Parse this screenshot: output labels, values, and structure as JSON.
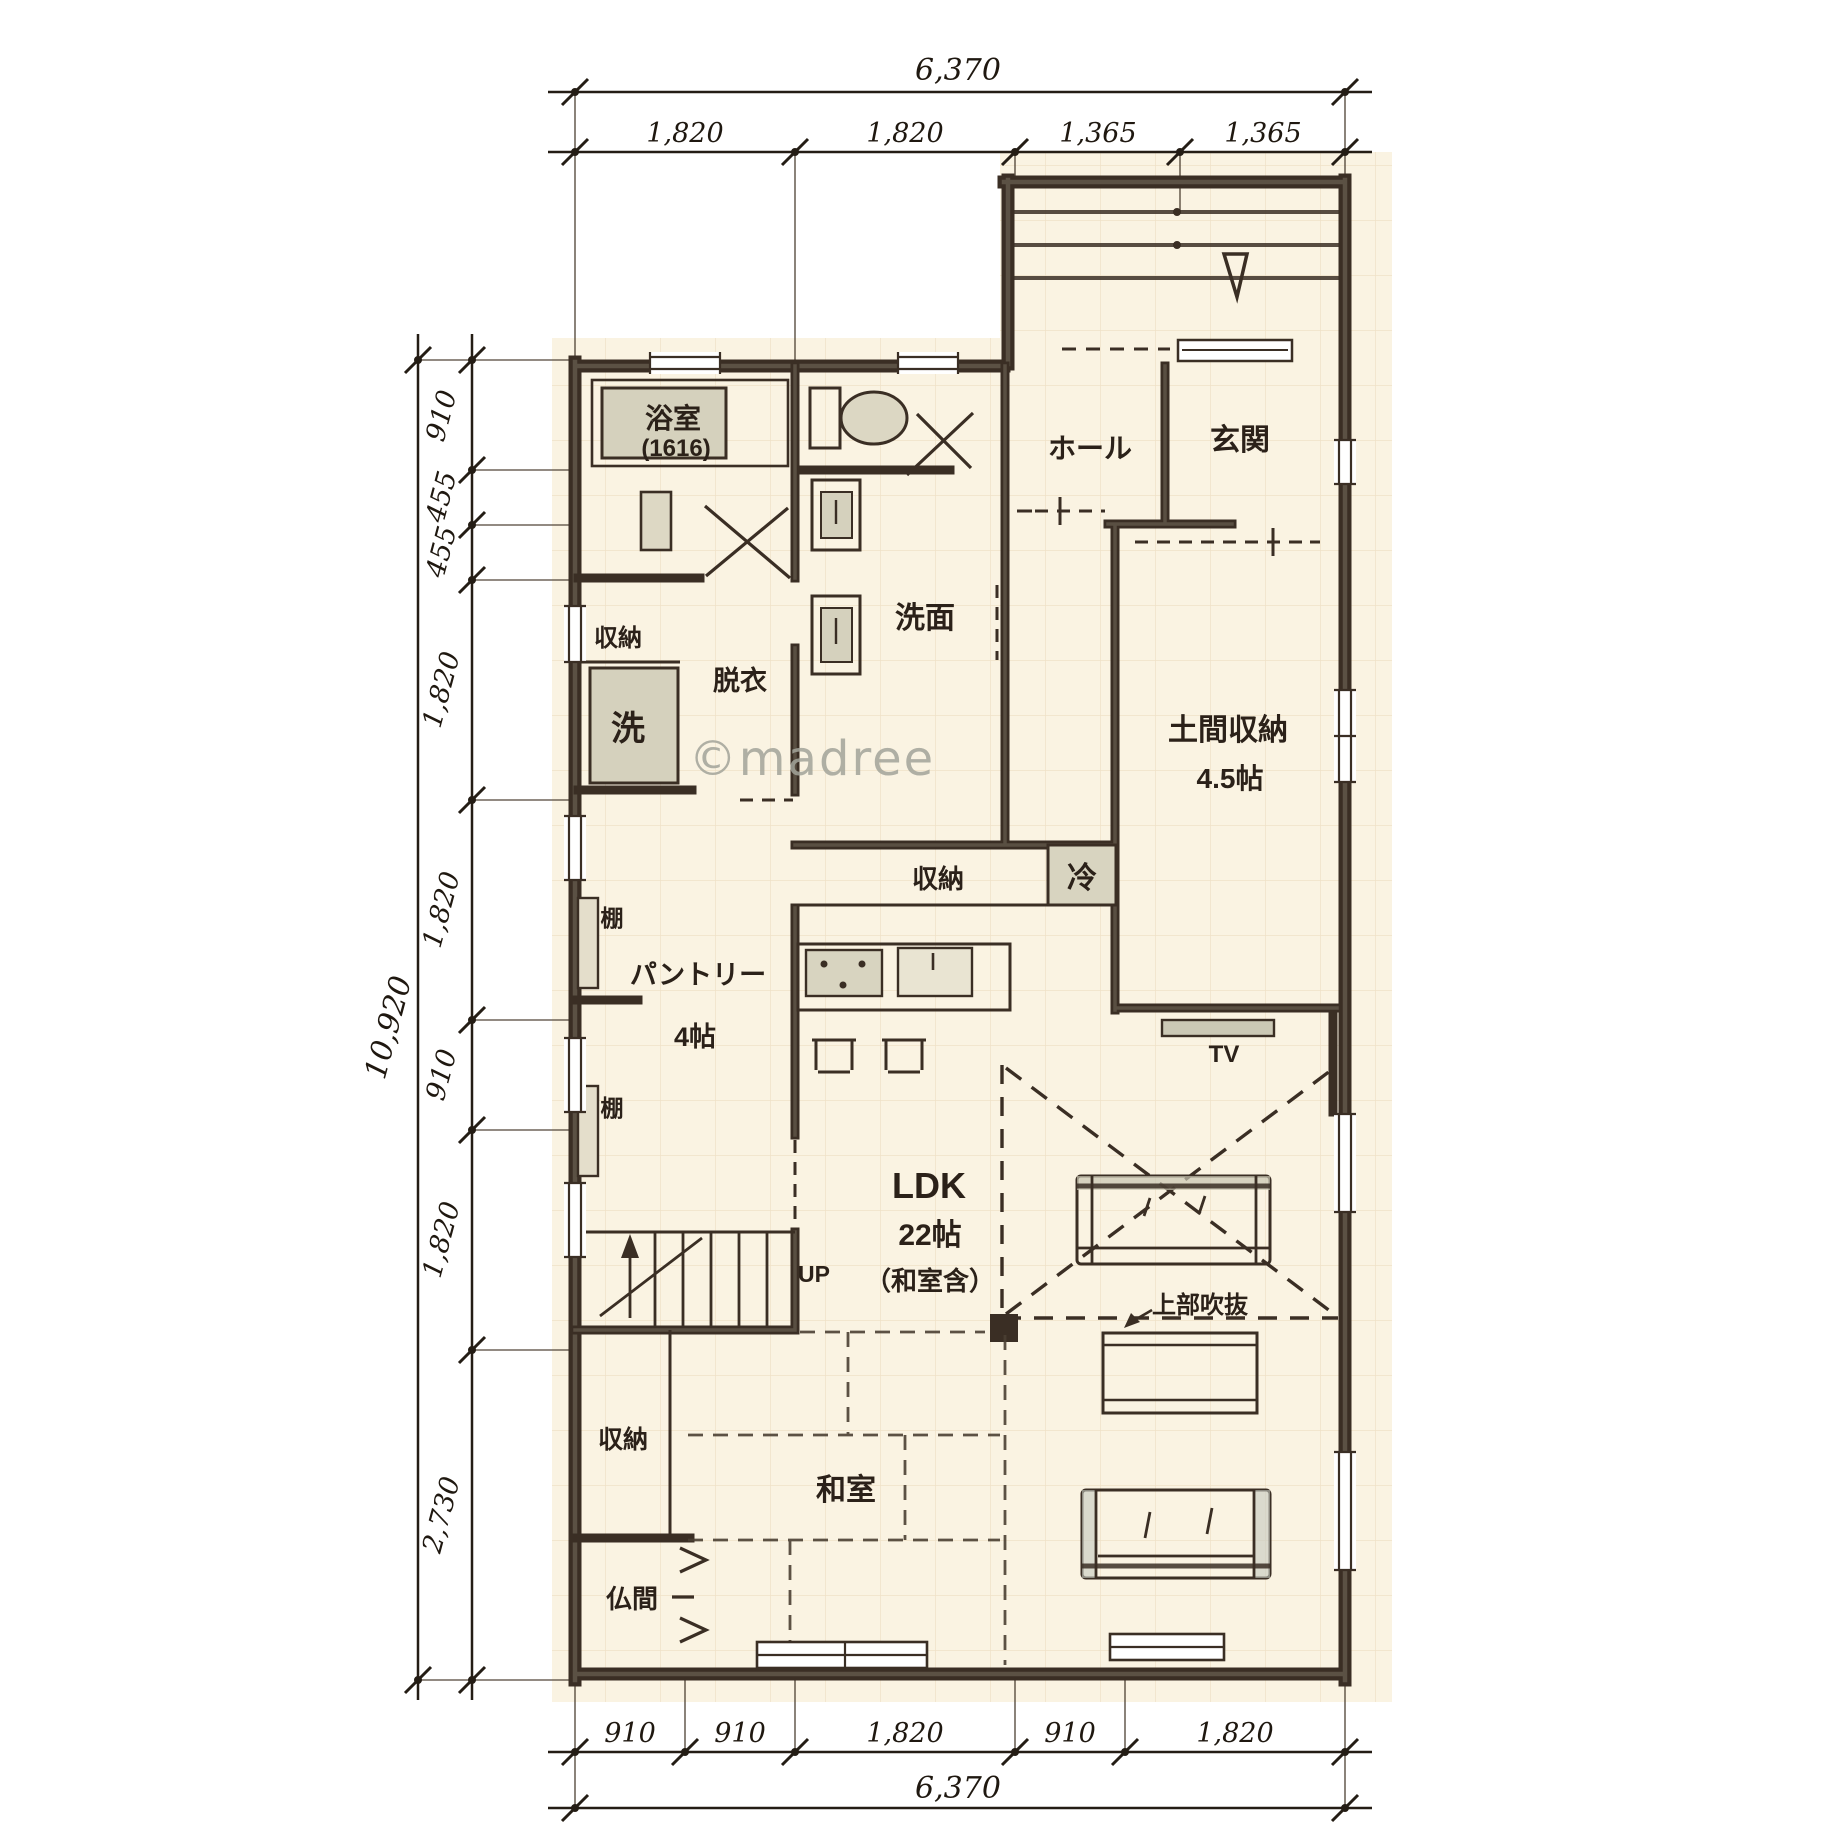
{
  "watermark": "©madree",
  "dimensions": {
    "top": {
      "overall": "6,370",
      "segments": [
        "1,820",
        "1,820",
        "1,365",
        "1,365"
      ]
    },
    "left": {
      "overall": "10,920",
      "segments": [
        "910",
        "455",
        "455",
        "1,820",
        "1,820",
        "910",
        "1,820",
        "2,730"
      ]
    },
    "bottom": {
      "overall": "6,370",
      "segments": [
        "910",
        "910",
        "1,820",
        "910",
        "1,820"
      ]
    }
  },
  "rooms": {
    "bath": {
      "name": "浴室",
      "size": "(1616)"
    },
    "bath_closet": "収納",
    "washer": "洗",
    "dressing": "脱衣",
    "washroom": "洗面",
    "hall": "ホール",
    "entrance": "玄関",
    "doma": {
      "name": "土間収納",
      "size": "4.5帖"
    },
    "pantry": {
      "name": "パントリー",
      "size": "4帖"
    },
    "shelf_upper": "棚",
    "shelf_lower": "棚",
    "kitchen_storage": "収納",
    "fridge": "冷",
    "ldk": {
      "name": "LDK",
      "size": "22帖",
      "note": "（和室含）"
    },
    "tv": "TV",
    "up": "UP",
    "void": "上部吹抜",
    "washitsu": "和室",
    "washitsu_closet": "収納",
    "butsuma": "仏間"
  },
  "colors": {
    "paper": "#faf3e2",
    "grid": "#ecdcc0",
    "ink": "#2b2119",
    "wall": "#3a2e24",
    "wall_core": "#77705f",
    "fixture_fill": "#d5d1bd",
    "watermark": "#a3a49a"
  }
}
